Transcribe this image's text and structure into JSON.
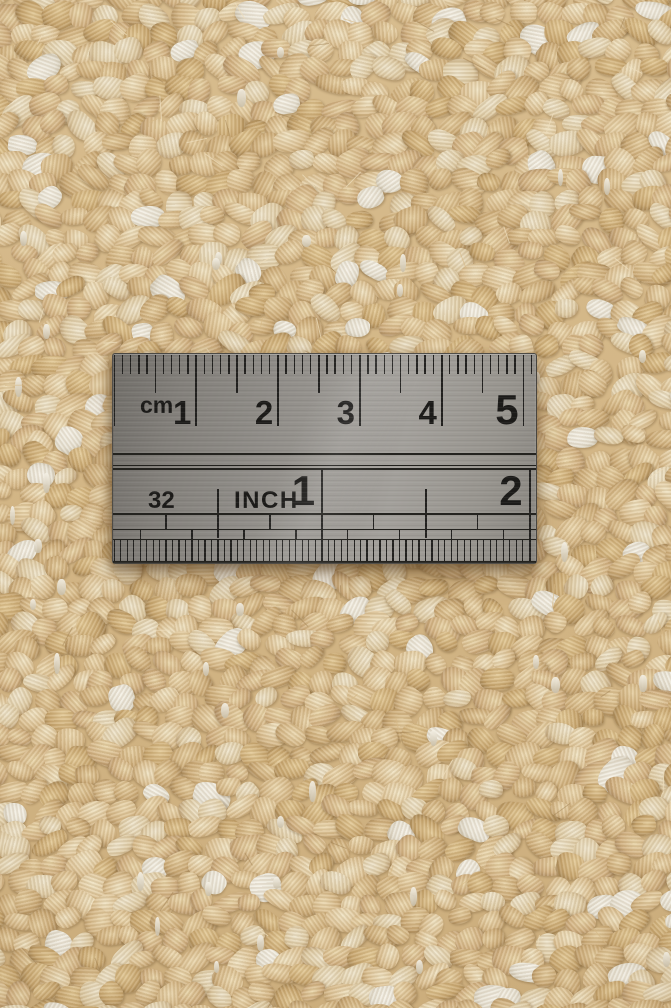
{
  "scene": {
    "type": "photograph",
    "subject": "Stainless steel ruler lying on a beige woven wool rug, top-down close-up"
  },
  "ruler": {
    "cm_scale": {
      "unit_label": "cm",
      "numbers": [
        "1",
        "2",
        "3",
        "4",
        "5"
      ]
    },
    "inch_scale": {
      "fraction_label": "32",
      "unit_label": "INCH",
      "numbers": [
        "1",
        "2"
      ]
    },
    "colors": {
      "metal_light": "#a3a09b",
      "metal_dark": "#716e69",
      "markings": "#1c1b19"
    }
  },
  "carpet": {
    "base_color": "#cfb282",
    "yarn_palettes": [
      [
        "#f0e3c2",
        "#ddc294",
        "#b3905c"
      ],
      [
        "#ecd9b0",
        "#d6b887",
        "#a98756"
      ],
      [
        "#e6cfa1",
        "#cdac78",
        "#9c7c4e"
      ],
      [
        "#efe5cc",
        "#e0cda6",
        "#b3946a"
      ],
      [
        "#e9d5a8",
        "#d2b181",
        "#a2825a"
      ],
      [
        "#e3c995",
        "#c9a76f",
        "#957648"
      ]
    ],
    "warp_palette": [
      "#f5f1e6",
      "#e9e4d6",
      "#c9bfa9"
    ],
    "fiber_colors": [
      "rgba(214,184,134,0.65)",
      "rgba(238,222,188,0.75)",
      "rgba(160,128,82,0.5)"
    ]
  }
}
